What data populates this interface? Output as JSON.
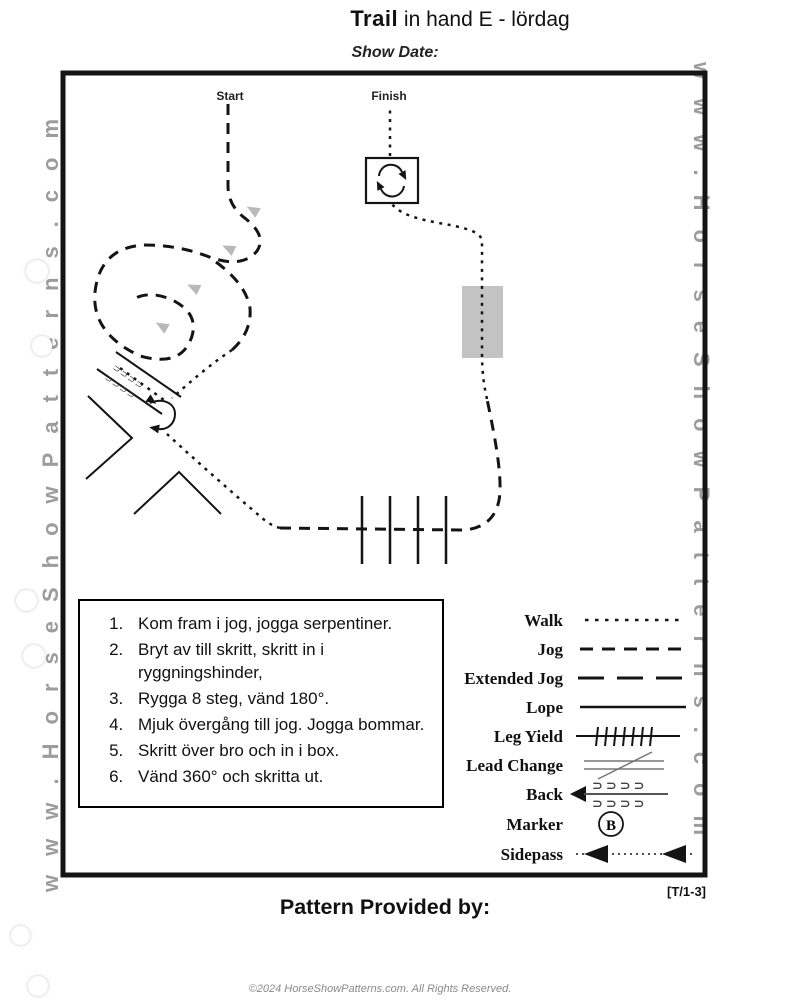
{
  "page": {
    "title_bold": "Trail",
    "title_rest": " in hand E - lördag",
    "show_date_label": "Show Date:",
    "pattern_code": "[T/1-3]",
    "provided_by": "Pattern Provided by:",
    "footer": "©2024 HorseShowPatterns.com. All Rights Reserved."
  },
  "watermark": {
    "left": "www.HorseShowPatterns.com",
    "right": "www.HorseShowPatterns.com"
  },
  "diagram": {
    "start_label": "Start",
    "finish_label": "Finish",
    "back_glyph_rows": [
      "⊃⊃⊃⊃",
      "⊃⊃⊃⊃"
    ],
    "obstacles": [
      "serpentine",
      "back-through chute with 180° turn",
      "V rails",
      "4 jog poles",
      "bridge",
      "360° turn box"
    ]
  },
  "instructions": {
    "items": [
      "Kom fram i jog, jogga serpentiner.",
      "Bryt av till skritt, skritt in i ryggningshinder,",
      "Rygga 8 steg, vänd 180°.",
      "Mjuk övergång till jog. Jogga bommar.",
      "Skritt över bro och in i box.",
      "Vänd 360° och skritta ut."
    ]
  },
  "legend": {
    "items": [
      {
        "label": "Walk",
        "style": "dotted"
      },
      {
        "label": "Jog",
        "style": "dashed"
      },
      {
        "label": "Extended Jog",
        "style": "long-dash"
      },
      {
        "label": "Lope",
        "style": "solid"
      },
      {
        "label": "Leg Yield",
        "style": "hatched-line"
      },
      {
        "label": "Lead Change",
        "style": "crossed-lines"
      },
      {
        "label": "Back",
        "style": "arrow-with-hooks",
        "glyphs": "⊃⊃⊃⊃"
      },
      {
        "label": "Marker",
        "style": "circled-letter",
        "letter": "B"
      },
      {
        "label": "Sidepass",
        "style": "dotted-double-arrow"
      }
    ]
  },
  "colors": {
    "ink": "#141414",
    "watermark_gray": "#9c9c9c",
    "bridge_gray": "#c3c3c3",
    "arrow_gray": "#b9b9b9",
    "footer_gray": "#8a8a8a"
  }
}
